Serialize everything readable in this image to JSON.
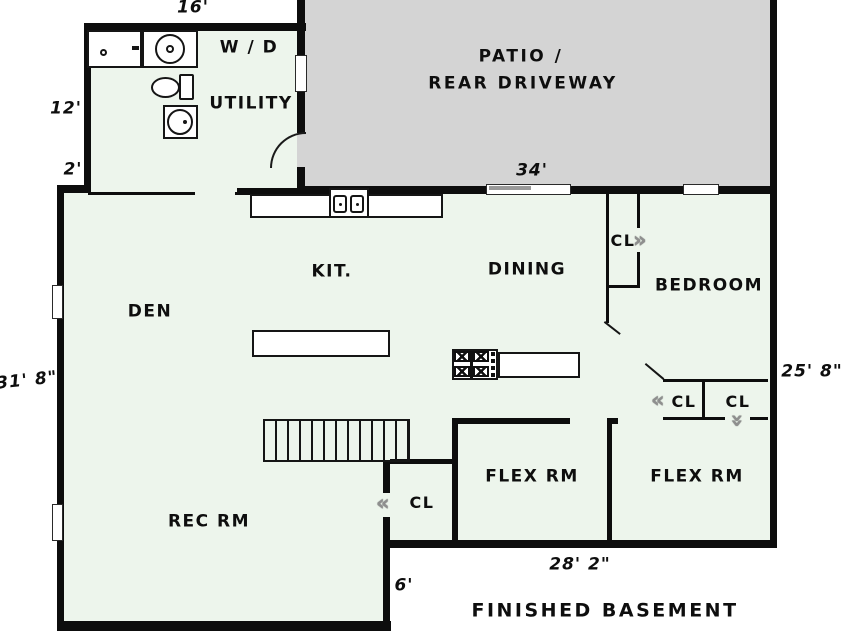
{
  "plan_title": "FINISHED BASEMENT",
  "colors": {
    "floor": "#edf5ec",
    "patio": "#d4d4d4",
    "wall": "#0d0d0d"
  },
  "rooms": {
    "den": "DEN",
    "kitchen": "KIT.",
    "dining": "DINING",
    "bedroom": "BEDROOM",
    "utility": "UTILITY",
    "washer_dryer": "W / D",
    "patio_line1": "PATIO /",
    "patio_line2": "REAR DRIVEWAY",
    "flex_left": "FLEX RM",
    "flex_right": "FLEX RM",
    "rec_room": "REC RM"
  },
  "closets": {
    "dining": "CL",
    "bedroom_left": "CL",
    "bedroom_right": "CL",
    "rec": "CL"
  },
  "dimensions": {
    "utility_width": "16'",
    "utility_left": "12'",
    "left_step": "2'",
    "left_height": "31' 8\"",
    "right_height": "25' 8\"",
    "patio_width": "34'",
    "bottom_width": "28' 2\"",
    "bottom_step": "6'"
  },
  "symbols": {
    "chevron_left": "«",
    "chevron_right": "»"
  }
}
